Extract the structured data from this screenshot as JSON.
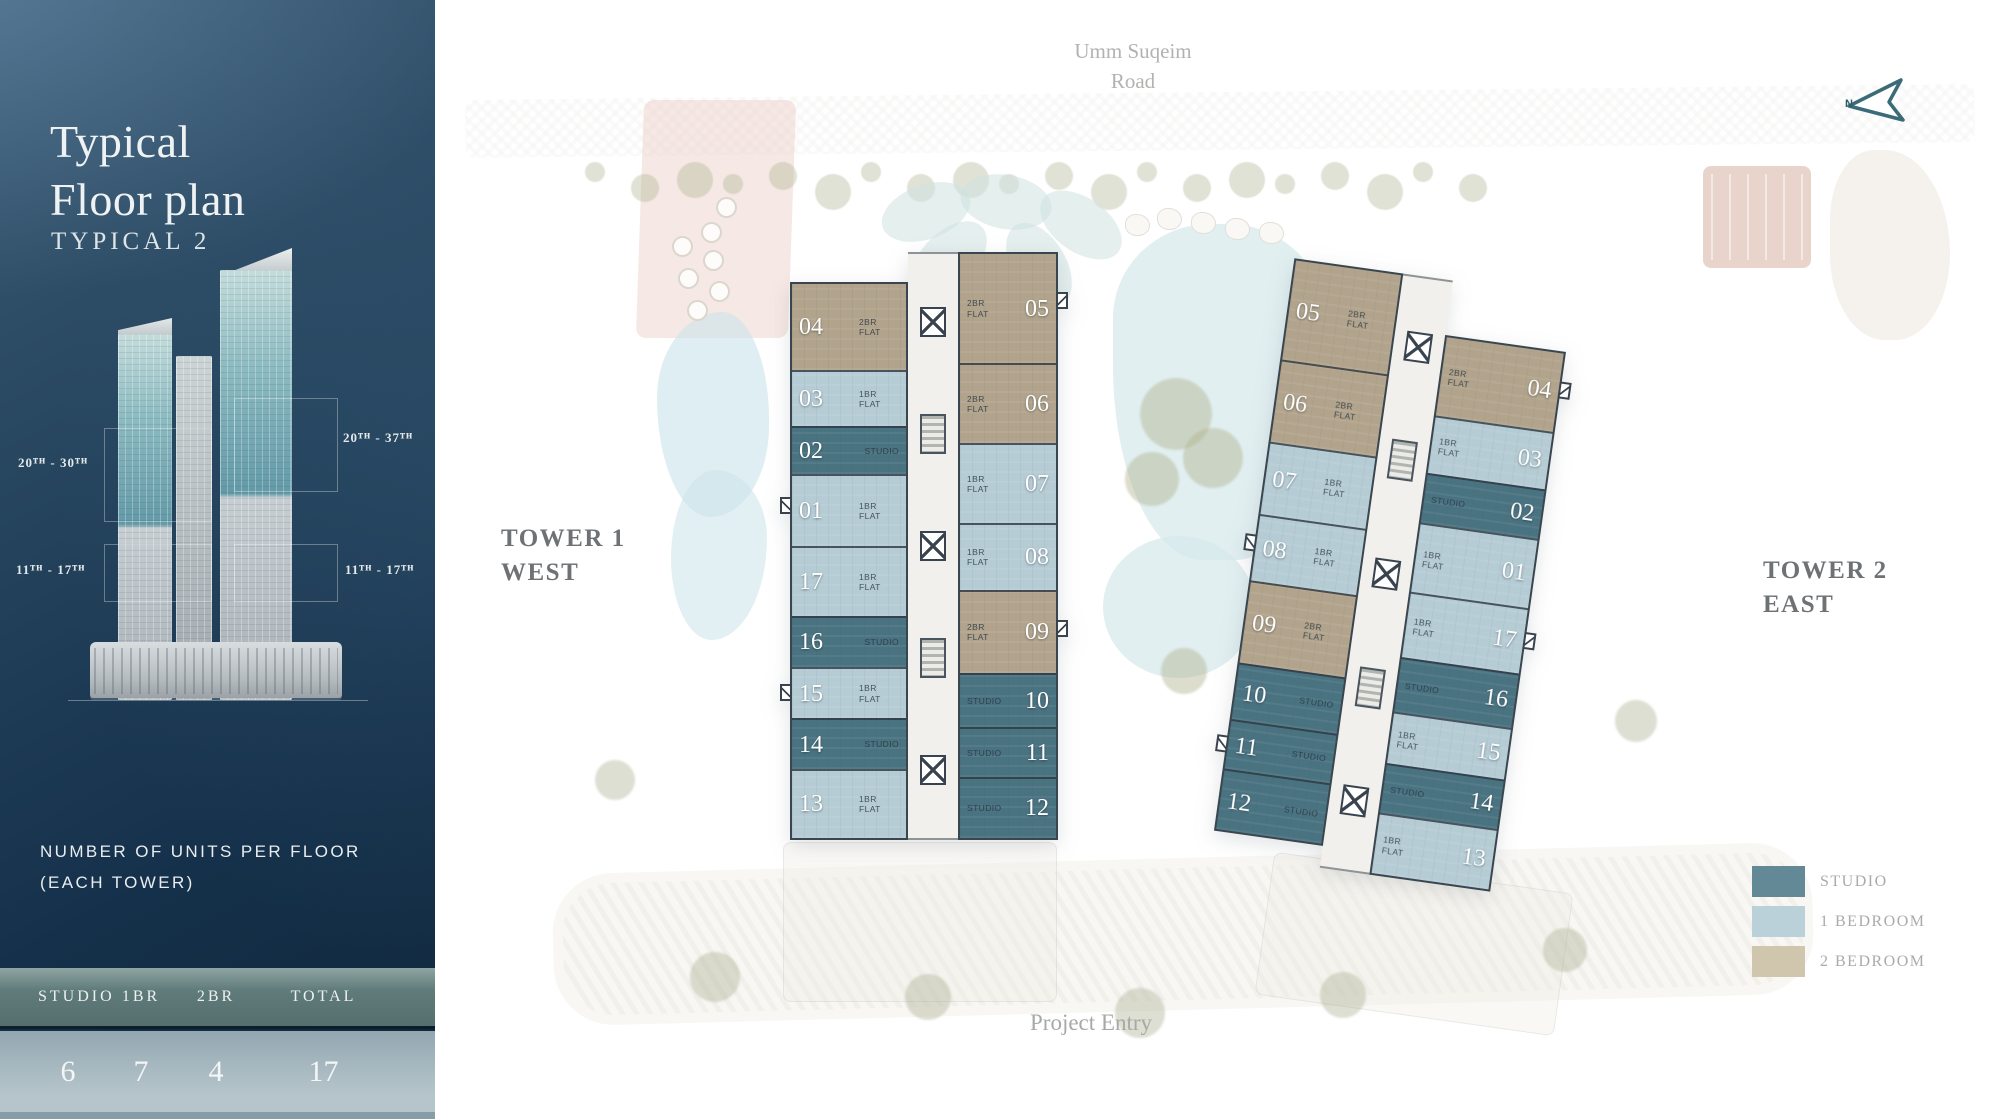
{
  "sidebar": {
    "title_line1": "Typical",
    "title_line2": "Floor plan",
    "subtitle": "TYPICAL 2",
    "ranges": {
      "left_upper": "20ᵀᴴ - 30ᵀᴴ",
      "left_lower": "11ᵀᴴ - 17ᵀᴴ",
      "right_upper": "20ᵀᴴ - 37ᵀᴴ",
      "right_lower": "11ᵀᴴ - 17ᵀᴴ"
    },
    "units_note_line1": "NUMBER OF UNITS PER FLOOR",
    "units_note_line2": "(EACH TOWER)",
    "table": {
      "headers": [
        "STUDIO",
        "1BR",
        "2BR",
        "TOTAL"
      ],
      "values": [
        "6",
        "7",
        "4",
        "17"
      ]
    }
  },
  "site": {
    "road_line1": "Umm Suqeim",
    "road_line2": "Road",
    "entry": "Project Entry",
    "north": "N"
  },
  "colors": {
    "studio": "#4a7381",
    "br1": "#b6ccd5",
    "br2": "#b2a48c",
    "arrow": "#3b6b77"
  },
  "legend": [
    {
      "label": "STUDIO",
      "color": "#628995"
    },
    {
      "label": "1 BEDROOM",
      "color": "#bad1da"
    },
    {
      "label": "2 BEDROOM",
      "color": "#d0c6ae"
    }
  ],
  "towers": [
    {
      "label_line1": "TOWER 1",
      "label_line2": "WEST",
      "left_units": [
        {
          "num": "04",
          "label": "2BR FLAT",
          "type": "br2",
          "h": 115
        },
        {
          "num": "03",
          "label": "1BR FLAT",
          "type": "br1",
          "h": 55
        },
        {
          "num": "02",
          "label": "STUDIO",
          "type": "studio",
          "h": 42
        },
        {
          "num": "01",
          "label": "1BR FLAT",
          "type": "br1",
          "h": 86
        },
        {
          "num": "17",
          "label": "1BR FLAT",
          "type": "br1",
          "h": 80
        },
        {
          "num": "16",
          "label": "STUDIO",
          "type": "studio",
          "h": 47
        },
        {
          "num": "15",
          "label": "1BR FLAT",
          "type": "br1",
          "h": 47
        },
        {
          "num": "14",
          "label": "STUDIO",
          "type": "studio",
          "h": 46
        },
        {
          "num": "13",
          "label": "1BR FLAT",
          "type": "br1",
          "h": 80
        }
      ],
      "right_units": [
        {
          "num": "05",
          "label": "2BR FLAT",
          "type": "br2",
          "h": 135
        },
        {
          "num": "06",
          "label": "2BR FLAT",
          "type": "br2",
          "h": 85
        },
        {
          "num": "07",
          "label": "1BR FLAT",
          "type": "br1",
          "h": 85
        },
        {
          "num": "08",
          "label": "1BR FLAT",
          "type": "br1",
          "h": 65
        },
        {
          "num": "09",
          "label": "2BR FLAT",
          "type": "br2",
          "h": 90
        },
        {
          "num": "10",
          "label": "STUDIO",
          "type": "studio",
          "h": 45
        },
        {
          "num": "11",
          "label": "STUDIO",
          "type": "studio",
          "h": 37
        },
        {
          "num": "12",
          "label": "STUDIO",
          "type": "studio",
          "h": 56
        }
      ]
    },
    {
      "label_line1": "TOWER 2",
      "label_line2": "EAST",
      "left_units": [
        {
          "num": "05",
          "label": "2BR FLAT",
          "type": "br2",
          "h": 120
        },
        {
          "num": "06",
          "label": "2BR FLAT",
          "type": "br2",
          "h": 90
        },
        {
          "num": "07",
          "label": "1BR FLAT",
          "type": "br1",
          "h": 75
        },
        {
          "num": "08",
          "label": "1BR FLAT",
          "type": "br1",
          "h": 65
        },
        {
          "num": "09",
          "label": "2BR FLAT",
          "type": "br2",
          "h": 90
        },
        {
          "num": "10",
          "label": "STUDIO",
          "type": "studio",
          "h": 50
        },
        {
          "num": "11",
          "label": "STUDIO",
          "type": "studio",
          "h": 38
        },
        {
          "num": "12",
          "label": "STUDIO",
          "type": "studio",
          "h": 55
        }
      ],
      "right_units": [
        {
          "num": "04",
          "label": "2BR FLAT",
          "type": "br2",
          "h": 95
        },
        {
          "num": "03",
          "label": "1BR FLAT",
          "type": "br1",
          "h": 55
        },
        {
          "num": "02",
          "label": "STUDIO",
          "type": "studio",
          "h": 42
        },
        {
          "num": "01",
          "label": "1BR FLAT",
          "type": "br1",
          "h": 75
        },
        {
          "num": "17",
          "label": "1BR FLAT",
          "type": "br1",
          "h": 70
        },
        {
          "num": "16",
          "label": "STUDIO",
          "type": "studio",
          "h": 50
        },
        {
          "num": "15",
          "label": "1BR FLAT",
          "type": "br1",
          "h": 45
        },
        {
          "num": "14",
          "label": "STUDIO",
          "type": "studio",
          "h": 42
        },
        {
          "num": "13",
          "label": "1BR FLAT",
          "type": "br1",
          "h": 60
        }
      ]
    }
  ]
}
